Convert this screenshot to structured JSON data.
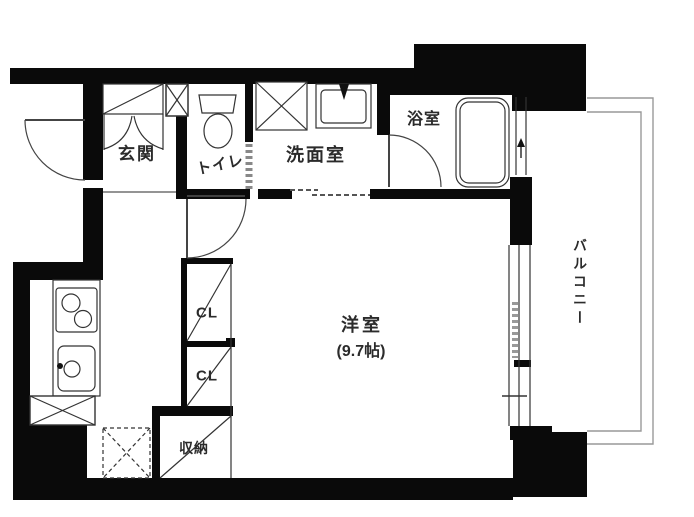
{
  "floor_plan": {
    "rooms": {
      "genkan": {
        "label": "玄関"
      },
      "toilet": {
        "label": "トイレ"
      },
      "washroom": {
        "label": "洗面室"
      },
      "bathroom": {
        "label": "浴室"
      },
      "western_room": {
        "label": "洋室",
        "size": "(9.7帖)"
      },
      "balcony": {
        "label": "バルコニー"
      },
      "closet_1": {
        "label": "CL"
      },
      "closet_2": {
        "label": "CL"
      },
      "storage": {
        "label": "収納"
      }
    },
    "colors": {
      "wall": "#0a0a0a",
      "line": "#333333",
      "railing": "#999999",
      "background": "#ffffff"
    }
  }
}
